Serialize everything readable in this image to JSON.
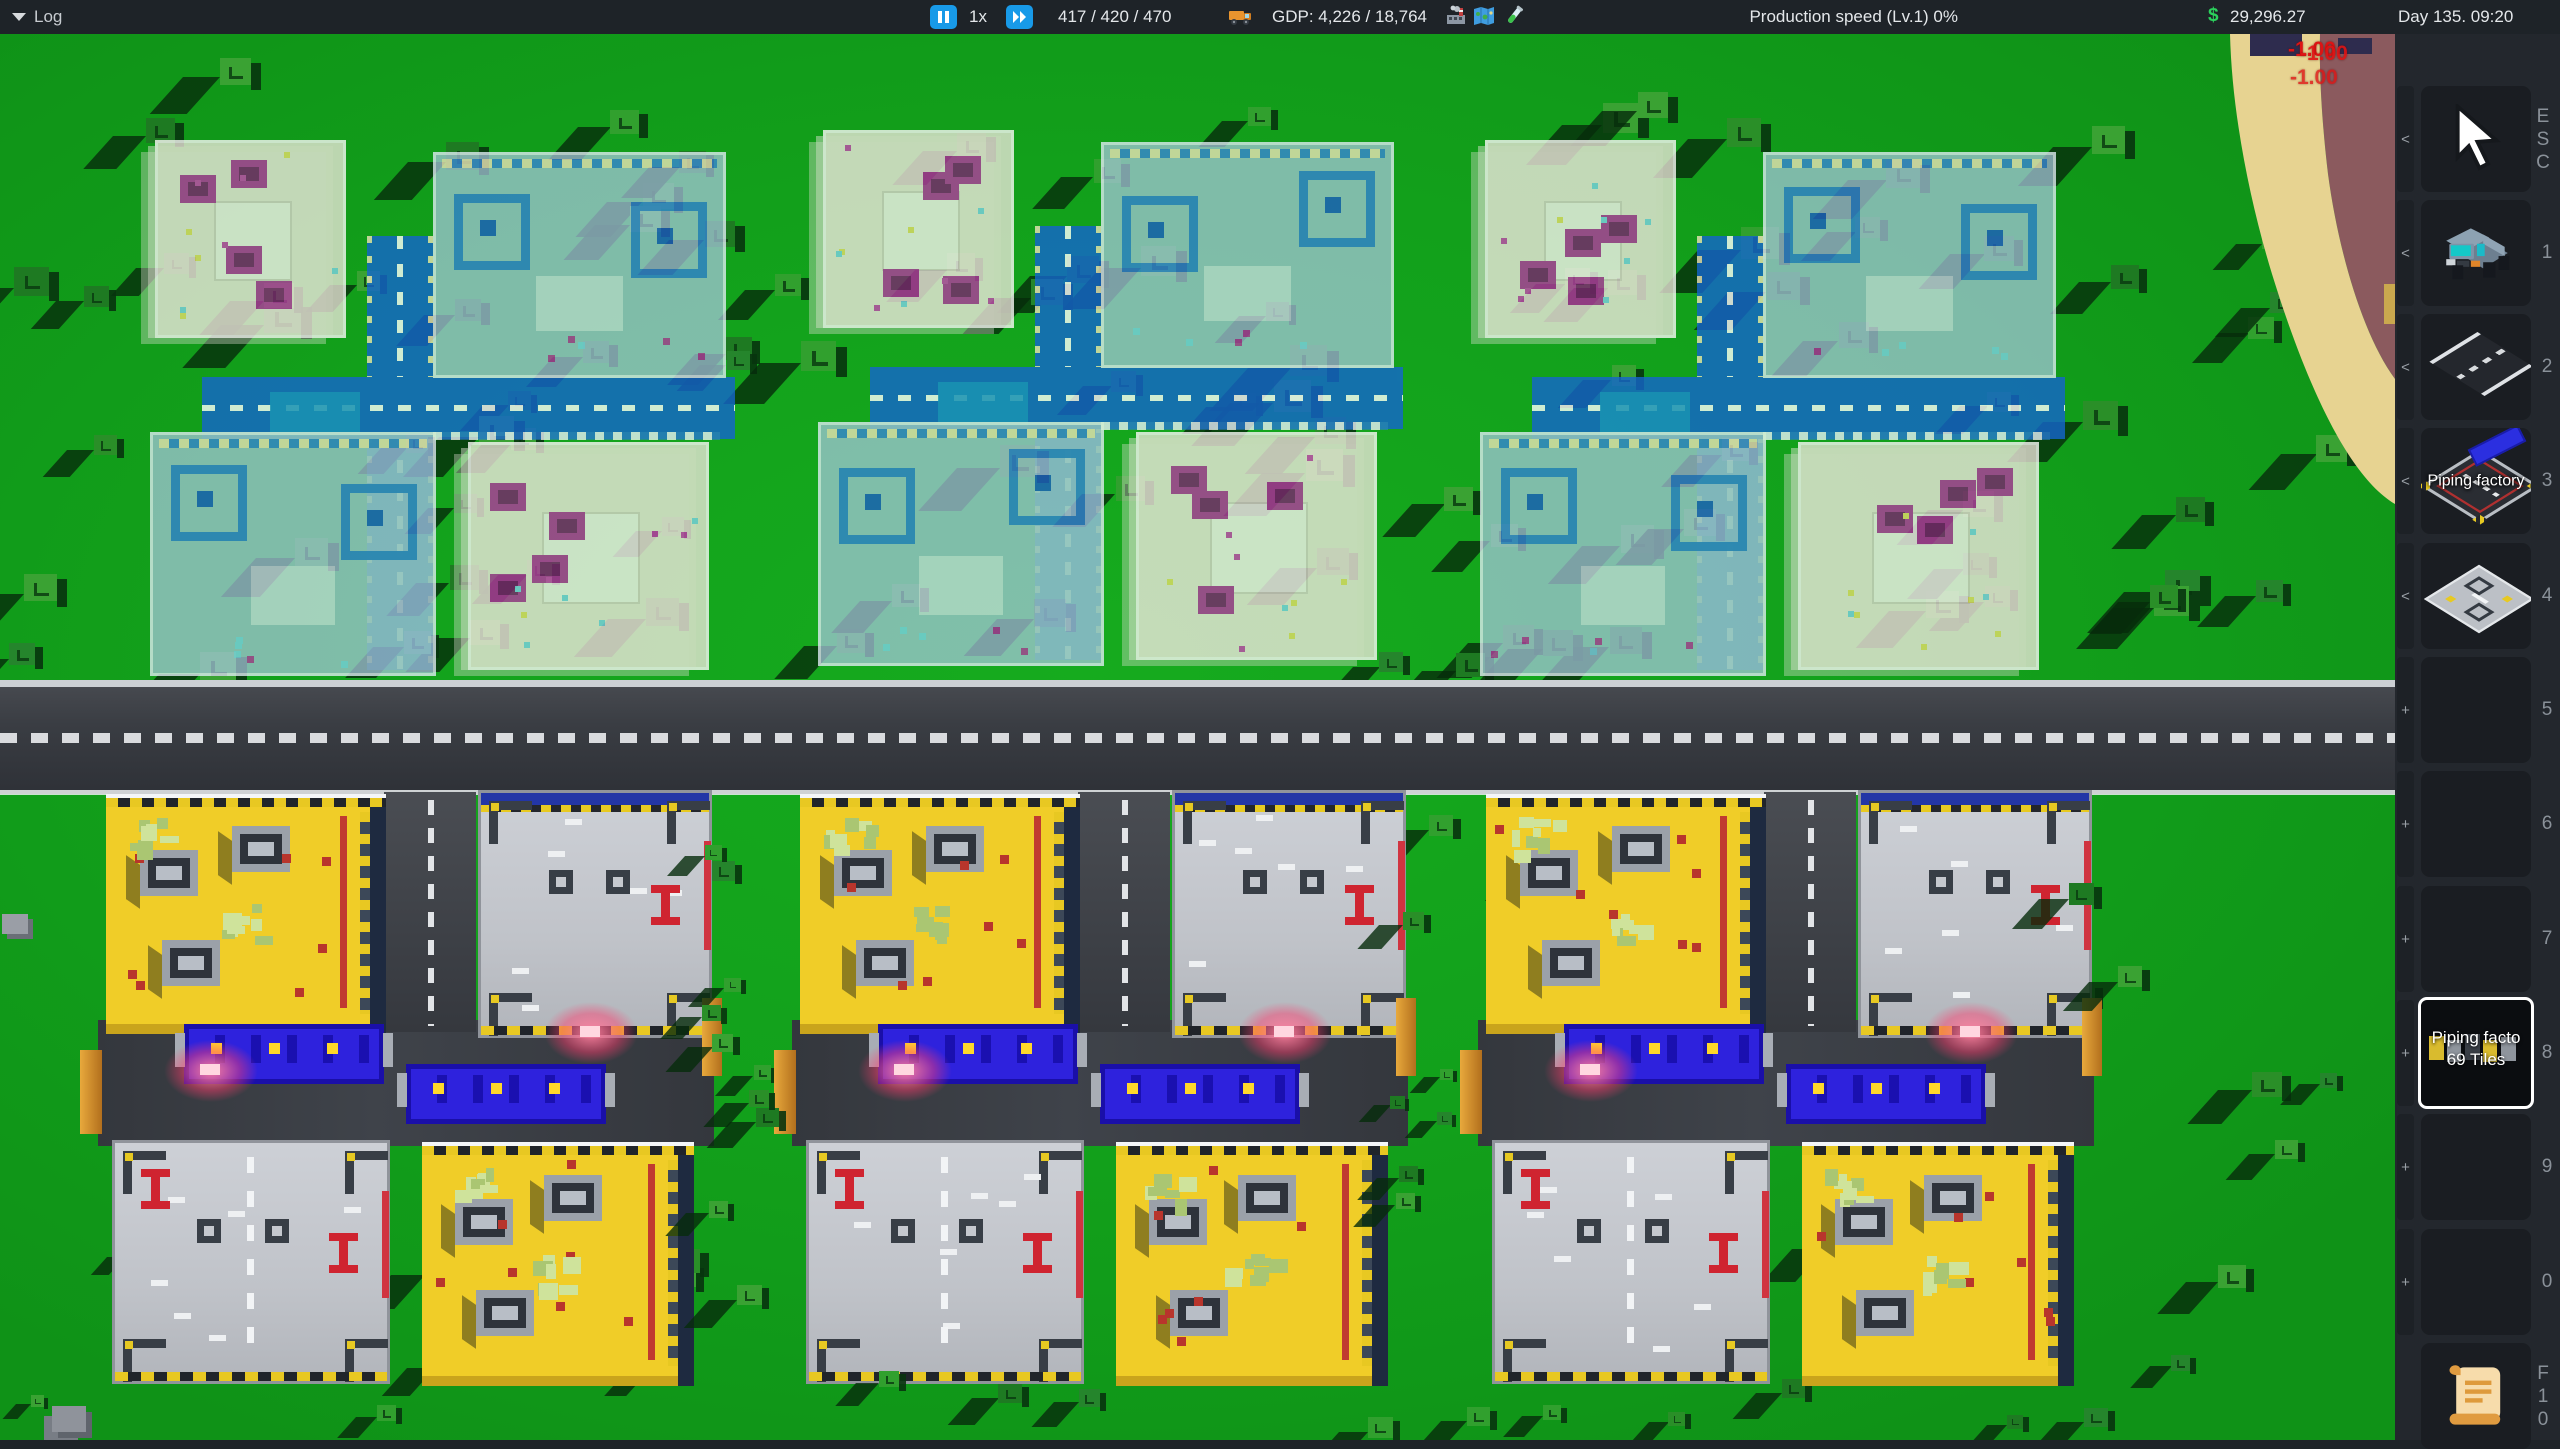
{
  "top_bar": {
    "log_label": "Log",
    "speed_label": "1x",
    "vehicles_count": "417 / 420 / 470",
    "gdp_label": "GDP: 4,226 / 18,764",
    "production_label": "Production speed (Lv.1) 0%",
    "currency_symbol": "$",
    "money": "29,296.27",
    "datetime": "Day 135. 09:20",
    "icons": {
      "pause": "pause-icon",
      "fast_forward": "fast-forward-icon",
      "vehicles": "truck-icon",
      "gdp": "factory-icon",
      "map": "map-icon",
      "research": "research-icon"
    }
  },
  "floating_costs": [
    "-1.00",
    "-1.00",
    "-1.00"
  ],
  "sidebar": {
    "slots": [
      {
        "shortcut": "ESC",
        "arrow": "<",
        "icon": "cursor-icon",
        "label": ""
      },
      {
        "shortcut": "1",
        "arrow": "<",
        "icon": "truck-icon",
        "label": ""
      },
      {
        "shortcut": "2",
        "arrow": "<",
        "icon": "road-tile-icon",
        "label": ""
      },
      {
        "shortcut": "3",
        "arrow": "<",
        "icon": "piping-factory-icon",
        "label": "Piping factory"
      },
      {
        "shortcut": "4",
        "arrow": "<",
        "icon": "factory-floor-icon",
        "label": ""
      },
      {
        "shortcut": "5",
        "arrow": "+",
        "icon": null,
        "label": ""
      },
      {
        "shortcut": "6",
        "arrow": "+",
        "icon": null,
        "label": ""
      },
      {
        "shortcut": "7",
        "arrow": "+",
        "icon": null,
        "label": ""
      },
      {
        "shortcut": "8",
        "arrow": "+",
        "icon": "blueprint-thumbnail",
        "label": "Piping facto",
        "sublabel": "69 Tiles",
        "selected": true
      },
      {
        "shortcut": "9",
        "arrow": "+",
        "icon": null,
        "label": ""
      },
      {
        "shortcut": "0",
        "arrow": "+",
        "icon": null,
        "label": ""
      },
      {
        "shortcut": "F10",
        "arrow": "",
        "icon": "log-scroll-icon",
        "label": ""
      }
    ]
  },
  "colors": {
    "accent_blue": "#189AE8",
    "money_green": "#2BD05C",
    "alert_red": "#DE1414",
    "selection_white": "#FFFFFF",
    "grass_green": "#12A01B",
    "blueprint_road_blue": "#1565CF",
    "factory_yellow": "#F0CD28",
    "conveyor_blue": "#2E22DD",
    "sand": "#E7D391",
    "cliff_maroon": "#8B5A5E"
  }
}
